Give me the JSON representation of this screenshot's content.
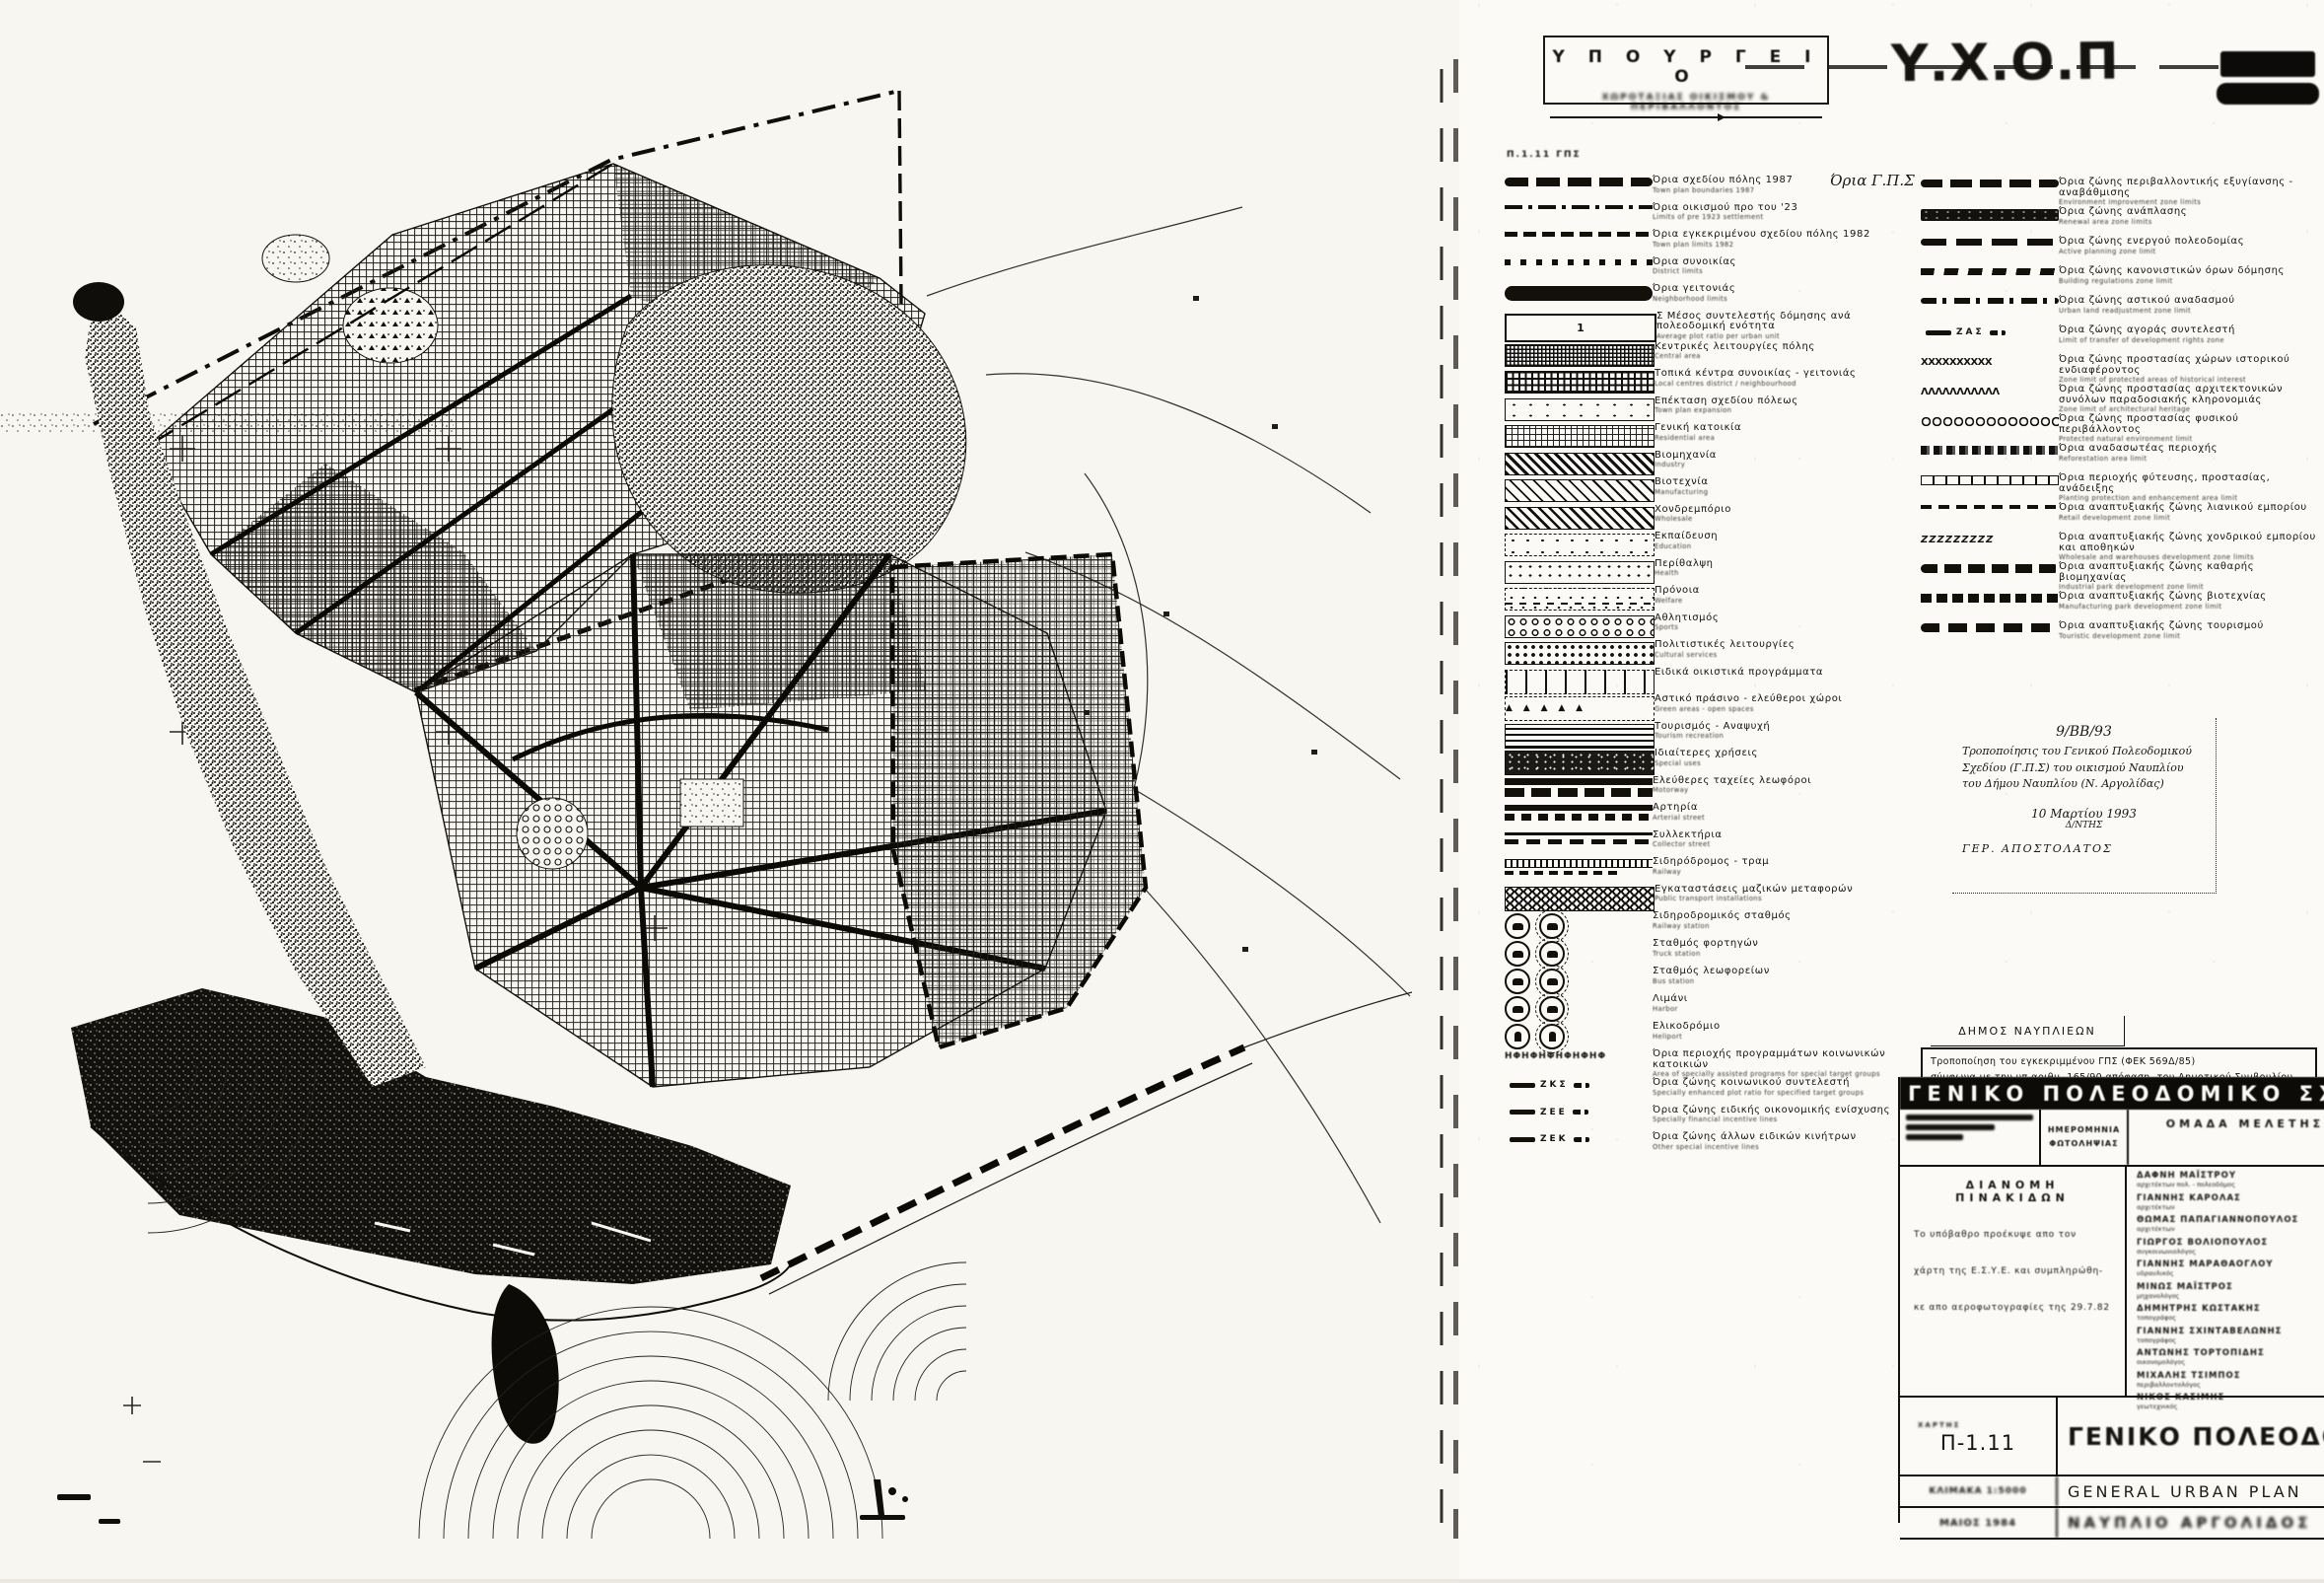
{
  "ministry_box": {
    "title": "Υ Π Ο Υ Ρ Γ Ε Ι Ο",
    "subtitle": "ΧΩΡΟΤΑΞΙΑΣ ΟΙΚΙΣΜΟΥ & ΠΕΡΙΒΑΛΛΟΝΤΟΣ"
  },
  "agency_logo": {
    "text": "Υ.Χ.Ο.Π"
  },
  "sheet_ref": "Π.1.11  ΓΠΣ",
  "legend_left": {
    "items": [
      {
        "id": "town-plan-boundaries-1987",
        "symbol": "boundary-gps",
        "gr": "Όρια σχεδίου πόλης 1987",
        "en": "Town plan boundaries 1987",
        "note": "Όρια Γ.Π.Σ"
      },
      {
        "id": "pre-1923-settlement",
        "symbol": "line-dashdot",
        "gr": "Όρια οικισμού προ του '23",
        "en": "Limits of pre 1923 settlement"
      },
      {
        "id": "town-plan-limits-1982",
        "symbol": "line-dashed",
        "gr": "Όρια εγκεκριμένου σχεδίου πόλης 1982",
        "en": "Town plan limits 1982"
      },
      {
        "id": "district-limits",
        "symbol": "line-dotted",
        "gr": "Όρια συνοικίας",
        "en": "District limits"
      },
      {
        "id": "neighborhood-limits",
        "symbol": "bar-solid",
        "gr": "Όρια γειτονιάς",
        "en": "Neighborhood limits"
      },
      {
        "id": "average-plot-ratio",
        "symbol": "box-ratio",
        "value": "1",
        "gr": "Σ  Μέσος συντελεστής δόμησης ανά πολεοδομική ενότητα",
        "en": "Average plot ratio per urban unit"
      },
      {
        "id": "central-area",
        "symbol": "swatch-grid-dense",
        "gr": "Κεντρικές λειτουργίες πόλης",
        "en": "Central area"
      },
      {
        "id": "local-centres",
        "symbol": "swatch-grid",
        "gr": "Τοπικά κέντρα συνοικίας - γειτονιάς",
        "en": "Local centres district / neighbourhood"
      },
      {
        "id": "town-plan-expansion",
        "symbol": "swatch-sparse",
        "gr": "Επέκταση σχεδίου πόλεως",
        "en": "Town plan expansion"
      },
      {
        "id": "residential-area",
        "symbol": "swatch-grid-light",
        "gr": "Γενική κατοικία",
        "en": "Residential area"
      },
      {
        "id": "industry",
        "symbol": "swatch-diag-dense",
        "gr": "Βιομηχανία",
        "en": "Industry"
      },
      {
        "id": "manufacturing",
        "symbol": "swatch-diag",
        "gr": "Βιοτεχνία",
        "en": "Manufacturing"
      },
      {
        "id": "wholesale",
        "symbol": "swatch-diag2",
        "gr": "Χονδρεμπόριο",
        "en": "Wholesale"
      },
      {
        "id": "education",
        "symbol": "swatch-dots-sparse",
        "gr": "Εκπαίδευση",
        "en": "Education"
      },
      {
        "id": "health",
        "symbol": "swatch-dots",
        "gr": "Περίθαλψη",
        "en": "Health"
      },
      {
        "id": "welfare",
        "symbol": "swatch-dash-dots",
        "gr": "Πρόνοια",
        "en": "Welfare"
      },
      {
        "id": "sports",
        "symbol": "swatch-circles",
        "gr": "Αθλητισμός",
        "en": "Sports"
      },
      {
        "id": "cultural-services",
        "symbol": "swatch-dots-dense",
        "gr": "Πολιτιστικές λειτουργίες",
        "en": "Cultural services"
      },
      {
        "id": "special-housing-programs",
        "symbol": "swatch-ticks",
        "gr": "Ειδικά οικιστικά προγράμματα",
        "en": ""
      },
      {
        "id": "green-open-spaces",
        "symbol": "swatch-tri",
        "symbol_text": "▲ ▲ ▲ ▲ ▲",
        "gr": "Αστικό πράσινο - ελεύθεροι χώροι",
        "en": "Green areas - open spaces"
      },
      {
        "id": "tourism-recreation",
        "symbol": "swatch-hlines",
        "gr": "Τουρισμός - Αναψυχή",
        "en": "Tourism recreation"
      },
      {
        "id": "special-uses",
        "symbol": "swatch-mottle",
        "gr": "Ιδιαίτερες χρήσεις",
        "en": "Special uses"
      },
      {
        "id": "motorway",
        "symbol": "road-motorway",
        "gr": "Ελεύθερες ταχείες λεωφόροι",
        "en": "Motorway"
      },
      {
        "id": "arterial-street",
        "symbol": "road-arterial",
        "gr": "Αρτηρία",
        "en": "Arterial street"
      },
      {
        "id": "collector-street",
        "symbol": "road-collector",
        "gr": "Συλλεκτήρια",
        "en": "Collector street"
      },
      {
        "id": "railway-line",
        "symbol": "rail",
        "gr": "Σιδηρόδρομος - τραμ",
        "en": "Railway"
      },
      {
        "id": "public-transport-installations",
        "symbol": "swatch-honeycomb",
        "gr": "Εγκαταστάσεις μαζικών μεταφορών",
        "en": "Public transport installations"
      },
      {
        "id": "railway-station",
        "symbol": "icon-station",
        "gr": "Σιδηροδρομικός σταθμός",
        "en": "Railway station"
      },
      {
        "id": "truck-station",
        "symbol": "icon-truck",
        "gr": "Σταθμός φορτηγών",
        "en": "Truck station"
      },
      {
        "id": "bus-station",
        "symbol": "icon-bus",
        "gr": "Σταθμός λεωφορείων",
        "en": "Bus station"
      },
      {
        "id": "harbor",
        "symbol": "icon-harbor",
        "gr": "Λιμάνι",
        "en": "Harbor"
      },
      {
        "id": "heliport",
        "symbol": "icon-heliport",
        "gr": "Ελικοδρόμιο",
        "en": "Heliport"
      },
      {
        "id": "social-housing-area",
        "symbol": "line-phi",
        "symbol_text": "ΗΦΗΦΗΦΗΦΗΦΗΦ",
        "gr": "Όρια περιοχής προγραμμάτων κοινωνικών κατοικιών",
        "en": "Area of specially assisted programs for special target groups"
      },
      {
        "id": "social-plot-ratio-zone",
        "symbol": "marker",
        "marker": "ΖΚΣ",
        "gr": "Όρια ζώνης κοινωνικού συντελεστή",
        "en": "Specially enhanced plot ratio for specified target groups"
      },
      {
        "id": "special-financial-zone",
        "symbol": "marker",
        "marker": "ΖΕΕ",
        "gr": "Όρια ζώνης ειδικής οικονομικής ενίσχυσης",
        "en": "Specially financial incentive lines"
      },
      {
        "id": "other-incentive-zone",
        "symbol": "marker",
        "marker": "ΖΕΚ",
        "gr": "Όρια ζώνης άλλων ειδικών κινήτρων",
        "en": "Other special incentive lines"
      }
    ]
  },
  "legend_right": {
    "items": [
      {
        "id": "environmental-improvement-zone",
        "symbol": "line-bolddash",
        "gr": "Όρια ζώνης περιβαλλοντικής εξυγίανσης - αναβάθμισης",
        "en": "Environment improvement zone limits"
      },
      {
        "id": "renewal-zone",
        "symbol": "bar-mottle",
        "gr": "Όρια ζώνης ανάπλασης",
        "en": "Renewal area zone limits"
      },
      {
        "id": "active-planning-zone",
        "symbol": "line-blobdash",
        "gr": "Όρια ζώνης ενεργού πολεοδομίας",
        "en": "Active planning zone limit"
      },
      {
        "id": "building-regulation-zone",
        "symbol": "line-wavedash",
        "gr": "Όρια ζώνης κανονιστικών όρων δόμησης",
        "en": "Building regulations zone limit"
      },
      {
        "id": "urban-land-readjustment-zone",
        "symbol": "line-dashdot-blob",
        "gr": "Όρια ζώνης αστικού αναδασμού",
        "en": "Urban land readjustment zone limit"
      },
      {
        "id": "development-rights-zone",
        "symbol": "marker",
        "marker": "ΖΑΣ",
        "gr": "Όρια ζώνης αγοράς συντελεστή",
        "en": "Limit of transfer of development rights zone"
      },
      {
        "id": "historical-interest-zone",
        "symbol": "line-xxx",
        "symbol_text": "ΧΧΧΧΧΧΧΧΧΧ",
        "gr": "Όρια ζώνης προστασίας χώρων ιστορικού ενδιαφέροντος",
        "en": "Zone limit of protected areas of historical interest"
      },
      {
        "id": "architectural-heritage-zone",
        "symbol": "line-wave",
        "symbol_text": "ΛΛΛΛΛΛΛΛΛΛΛ",
        "gr": "Όρια ζώνης προστασίας αρχιτεκτονικών συνόλων παραδοσιακής κληρονομιάς",
        "en": "Zone limit of architectural heritage"
      },
      {
        "id": "natural-environment-zone",
        "symbol": "line-circles",
        "gr": "Όρια ζώνης προστασίας φυσικού περιβάλλοντος",
        "en": "Protected natural environment limit"
      },
      {
        "id": "reforestation-area",
        "symbol": "line-mottled",
        "gr": "Όρια αναδασωτέας περιοχής",
        "en": "Reforestation area limit"
      },
      {
        "id": "planting-protection-area",
        "symbol": "line-squares",
        "gr": "Όρια περιοχής φύτευσης, προστασίας, ανάδειξης",
        "en": "Planting protection and enhancement area limit"
      },
      {
        "id": "retail-development-zone",
        "symbol": "line-dash-thin",
        "gr": "Όρια αναπτυξιακής ζώνης λιανικού εμπορίου",
        "en": "Retail development zone limit"
      },
      {
        "id": "wholesale-warehouse-zone",
        "symbol": "line-zzz",
        "symbol_text": "ΖΖΖΖΖΖΖΖΖ",
        "gr": "Όρια αναπτυξιακής ζώνης χονδρικού εμπορίου και αποθηκών",
        "en": "Wholesale and warehouses development zone limits"
      },
      {
        "id": "industrial-park-zone",
        "symbol": "line-blobs",
        "gr": "Όρια αναπτυξιακής ζώνης καθαρής βιομηχανίας",
        "en": "Industrial park development zone limit"
      },
      {
        "id": "manufacturing-park-zone",
        "symbol": "line-dashblocks",
        "gr": "Όρια αναπτυξιακής ζώνης βιοτεχνίας",
        "en": "Manufacturing park development zone limit"
      },
      {
        "id": "tourist-development-zone",
        "symbol": "line-blobs2",
        "gr": "Όρια αναπτυξιακής ζώνης τουρισμού",
        "en": "Touristic development zone limit"
      }
    ]
  },
  "handwritten_note": {
    "ref": "9/ΒΒ/93",
    "body": "Τροποποίησις του Γενικού Πολεοδομικού Σχεδίου (Γ.Π.Σ) του οικισμού Ναυπλίου του Δήμου Ναυπλίου (Ν. Αργολίδας)",
    "date": "10 Μαρτίου 1993",
    "role": "Δ/ΝΤΗΣ",
    "signature": "ΓΕΡ. ΑΠΟΣΤΟΛΑΤΟΣ"
  },
  "municipality_box": {
    "name": "ΔΗΜΟΣ ΝΑΥΠΛΙΕΩΝ",
    "amendment_line1": "Τροποποίηση του εγκεκριμμένου ΓΠΣ (ΦΕΚ 569Δ/85)",
    "amendment_line2": "σύμφωνα με την υπ.αριθμ. 165/90 απόφαση. του Δημοτικού Συμβουλίου"
  },
  "title_block": {
    "band_title": "ΓΕΝΙΚΟ  ΠΟΛΕΟΔΟΜΙΚΟ  ΣΧΕΔΙΟ",
    "photo_date_header": "ΗΜΕΡΟΜΗΝΙΑ ΦΩΤΟΛΗΨΙΑΣ",
    "team_header": "ΟΜΑΔΑ  ΜΕΛΕΤΗΣ",
    "distribution": {
      "title": "ΔΙΑΝΟΜΗ   ΠΙΝΑΚΙΔΩΝ",
      "body_line1": "Το υπόβαθρο προέκυψε απο τον",
      "body_line2": "χάρτη της  Ε.Σ.Υ.Ε.  και συμπληρώθη-",
      "body_line3": "κε απο αεροφωτογραφίες της 29.7.82"
    },
    "team": {
      "members": [
        {
          "name": "ΔΑΦΝΗ ΜΑΪΣΤΡΟΥ",
          "role": "αρχιτέκτων πολ. - πολεοδόμος"
        },
        {
          "name": "ΓΙΑΝΝΗΣ ΚΑΡΟΛΑΣ",
          "role": "αρχιτέκτων"
        },
        {
          "name": "ΘΩΜΑΣ ΠΑΠΑΓΙΑΝΝΟΠΟΥΛΟΣ",
          "role": "αρχιτέκτων"
        },
        {
          "name": "ΓΙΩΡΓΟΣ ΒΟΛΙΟΠΟΥΛΟΣ",
          "role": "συγκοινωνιολόγος"
        },
        {
          "name": "ΓΙΑΝΝΗΣ ΜΑΡΑΘΑΟΓΛΟΥ",
          "role": "υδραυλικός"
        },
        {
          "name": "ΜΙΝΩΣ ΜΑΪΣΤΡΟΣ",
          "role": "μηχανολόγος"
        },
        {
          "name": "ΔΗΜΗΤΡΗΣ ΚΩΣΤΑΚΗΣ",
          "role": "τοπογράφος"
        },
        {
          "name": "ΓΙΑΝΝΗΣ ΣΧΙΝΤΑΒΕΛΩΝΗΣ",
          "role": "τοπογράφος"
        },
        {
          "name": "ΑΝΤΩΝΗΣ ΤΟΡΤΟΠΙΔΗΣ",
          "role": "οικονομολόγος"
        },
        {
          "name": "ΜΙΧΑΛΗΣ ΤΣΙΜΠΟΣ",
          "role": "περιβαλλοντολόγος"
        },
        {
          "name": "ΝΙΚΟΣ ΚΑΣΙΜΗΣ",
          "role": "γεωτεχνικός"
        }
      ]
    },
    "map_label": "ΧΑΡΤΗΣ",
    "map_no": "Π-1.11",
    "title_gr": "ΓΕΝΙΚΟ ΠΟΛΕΟΔΟΜΙΚΟ ΣΧΕΔΙΟ",
    "title_en": "GENERAL URBAN PLAN",
    "scale_text": "ΚΛΙΜΑΚΑ 1:5000",
    "date_text": "ΜΑΙΟΣ 1984",
    "place_text": "ΝΑΥΠΛΙΟ ΑΡΓΟΛΙΔΟΣ"
  }
}
